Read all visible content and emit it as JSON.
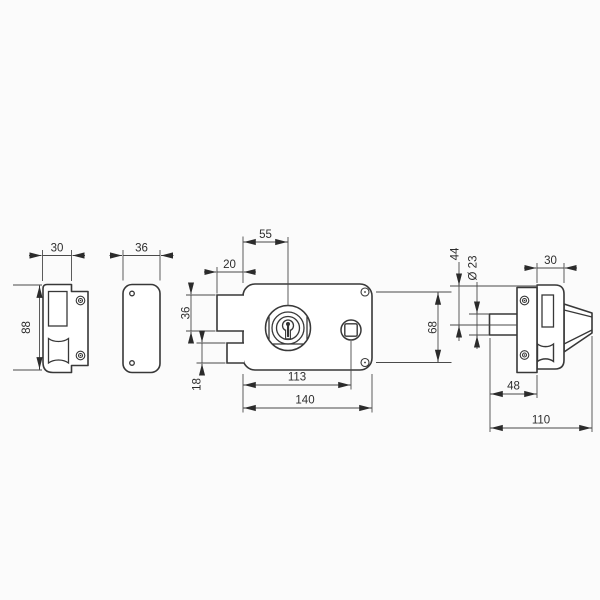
{
  "drawing": {
    "subject": "rim lock technical drawing with strike plate, profile, front and side views",
    "background": "#fbfbfb",
    "line_color": "#383838",
    "dimension_line_color": "#4a4a4a",
    "text_color": "#2d2d2d"
  },
  "dims": {
    "strike_width": "30",
    "strike_height": "88",
    "strike_side_width": "36",
    "cylinder_offset": "55",
    "latch_projection": "20",
    "latch_height": "36",
    "deadbolt_height": "18",
    "follower_offset": "113",
    "body_width": "140",
    "screw_spacing": "68",
    "case_top_to_axis": "44",
    "cylinder_diameter": "Ø 23",
    "case_width": "30",
    "cylinder_backset": "48",
    "total_depth": "110"
  }
}
